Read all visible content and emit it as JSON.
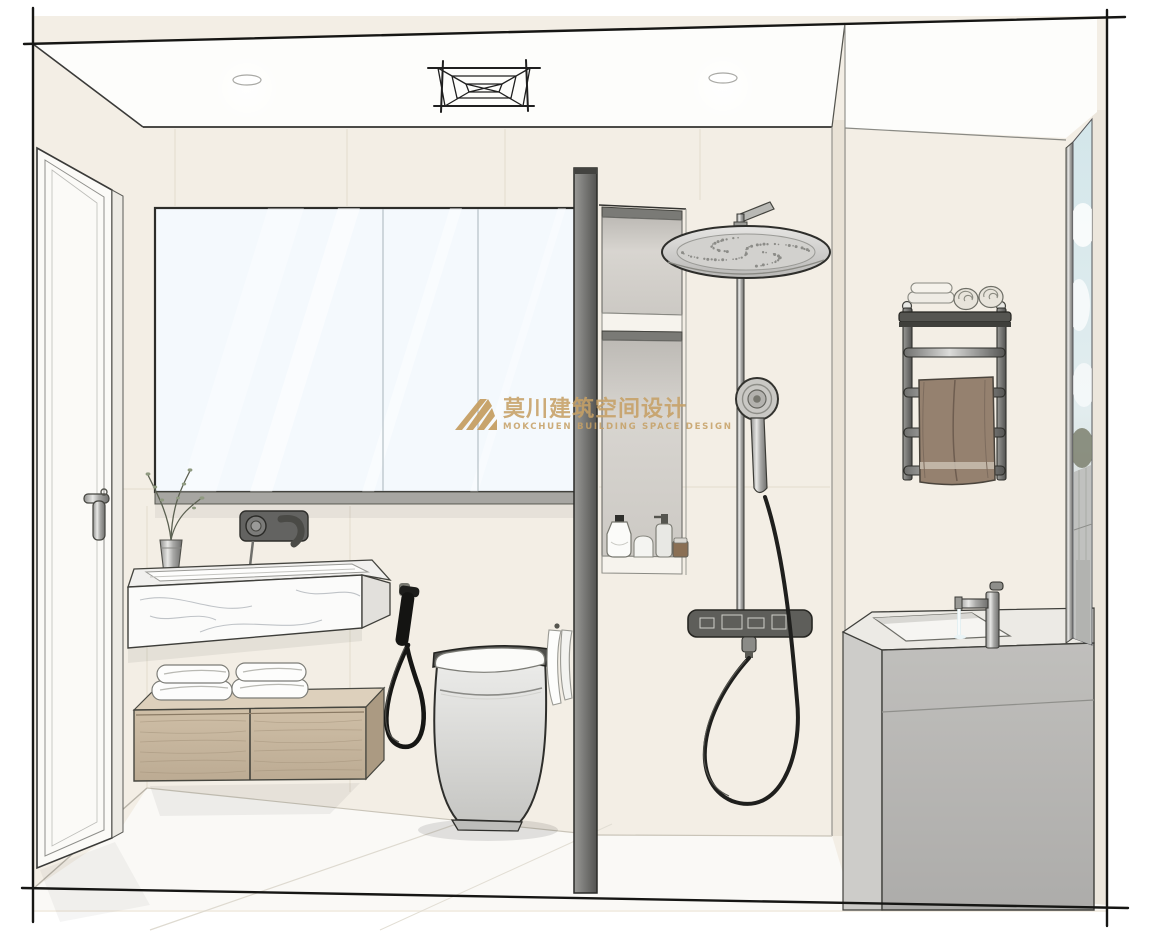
{
  "watermark": {
    "title": "莫川建筑空间设计",
    "subtitle": "MOKCHUEN BUILDING SPACE DESIGN",
    "color": "#c6a065"
  },
  "scene": {
    "type": "hand-drawn bathroom interior perspective rendering",
    "objects": [
      "entry door with lever handle",
      "mirror cabinet",
      "wall-mounted matte-gray basin faucet",
      "marble floating wash basin",
      "vase with plant sprigs",
      "wood floating drawer cabinet with folded towels",
      "black bidet sprayer with coiled hose",
      "smart toilet",
      "hand towel on partition hook",
      "partition wall with two recessed niches",
      "toiletry bottles in niche",
      "rainfall shower column with hand shower and mixer",
      "wall towel rack with rolled and folded towels",
      "brown hanging bath towel",
      "gray vanity cabinet with inset sink and chrome faucet",
      "tall narrow window with sky, greenery and buildings",
      "ceiling vent grille sketch",
      "two recessed ceiling downlights"
    ]
  },
  "palette": {
    "paper": "#ffffff",
    "line": "#1f1f1f",
    "wall": "#f3eee5",
    "wallShade": "#e9e2d6",
    "ceiling": "#fdfdfb",
    "floor": "#faf9f6",
    "mirror": "#f4f9fd",
    "marble": "#fbfbfa",
    "wood": "#c8b79f",
    "woodDark": "#ab9a82",
    "woodTop": "#ddd0bc",
    "grayCab": "#b7b6b3",
    "grayCabTop": "#eceae5",
    "grayCabSide": "#cdccc9",
    "partition": "#6a6a68",
    "niche": "#d3d0cb",
    "chrome": "#c9c8c6",
    "dark": "#4f4f4d",
    "towelBrown": "#95816f",
    "gold": "#c6a065",
    "sky": "#d3e6ea",
    "building": "#c0c1bf",
    "green": "#7d806e",
    "whiteTowel": "#fdfdfc"
  }
}
